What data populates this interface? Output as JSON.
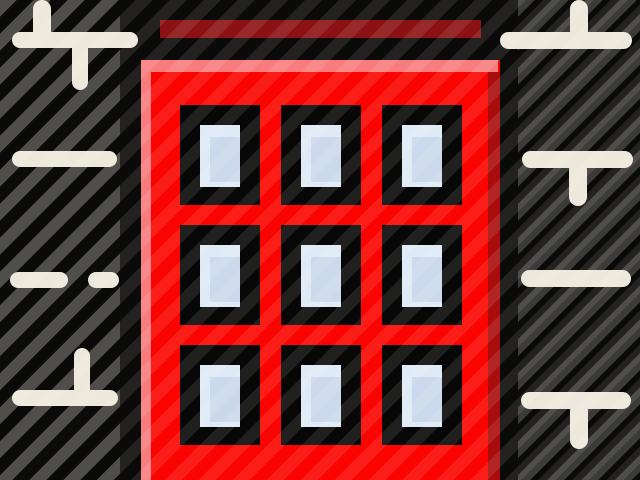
{
  "scene": {
    "type": "icon-illustration",
    "subject": "Red apartment building icon with a 3 by 3 grid of black framed light blue windows, a dark red roof slab above, centered on a black canvas between diagonal gray striped panels decorated with cream tick lines",
    "window_rows": 3,
    "window_cols": 3,
    "window_count": 9,
    "decor_line_count_left": 8,
    "decor_line_count_right": 7
  },
  "colors": {
    "background": "#070707",
    "canvas_black": "#0a0a09",
    "stripe_gray": "#3b3b37",
    "building_red": "#f90400",
    "highlight_pink": "#f87c7e",
    "shade_dark_red": "#a90d0b",
    "roof_dark_red": "#8c1113",
    "window_frame_black": "#070707",
    "pane_light": "#dfeaf7",
    "pane_shade": "#ccd9ec",
    "decor_cream": "#ece8db"
  }
}
